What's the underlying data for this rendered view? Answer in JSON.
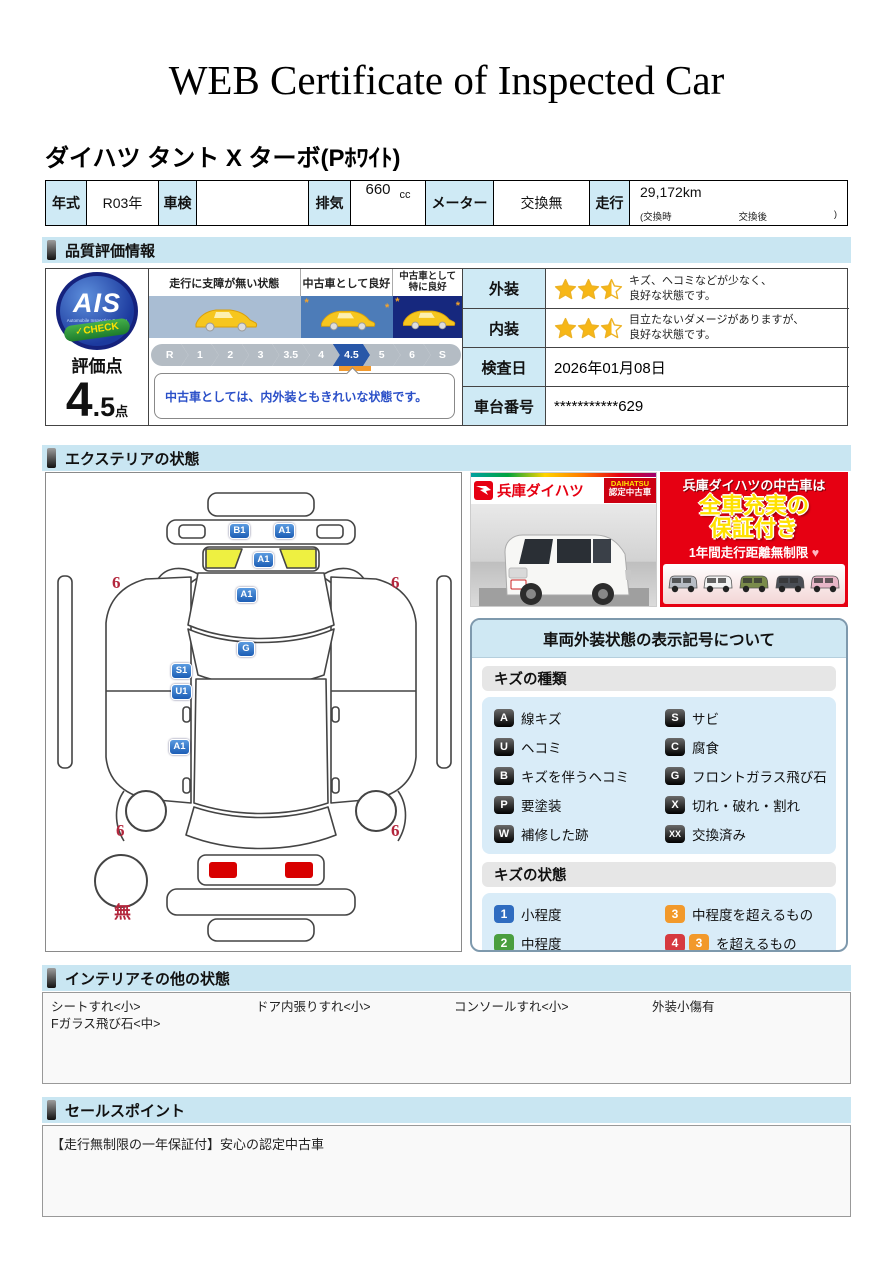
{
  "page": {
    "title": "WEB Certificate of Inspected Car"
  },
  "vehicle": {
    "name": "ダイハツ タント X ターボ(Pﾎﾜｲﾄ)",
    "info": {
      "year_label": "年式",
      "year": "R03年",
      "shaken_label": "車検",
      "shaken": "",
      "displacement_label": "排気",
      "displacement": "660",
      "displacement_unit": "cc",
      "meter_label": "メーター",
      "meter": "交換無",
      "mileage_label": "走行",
      "mileage": "29,172km",
      "mileage_note_open": "(交換時",
      "mileage_note_mid": "交換後",
      "mileage_note_close": ")"
    }
  },
  "quality": {
    "section_title": "品質評価情報",
    "ais": {
      "logo": "AIS",
      "logo_sub": "Automobile Inspection System",
      "logo_check": "✓CHECK",
      "score_label": "評価点",
      "score_int": "4",
      "score_dec": ".5",
      "score_unit": "点"
    },
    "scale": {
      "zones": [
        {
          "label": "走行に支障が無い状態",
          "color": "#a9bdd3"
        },
        {
          "label": "中古車として良好",
          "color": "#4d7cb8"
        },
        {
          "label": "中古車として\n特に良好",
          "color": "#16287e"
        }
      ],
      "ticks": [
        "R",
        "1",
        "2",
        "3",
        "3.5",
        "4",
        "4.5",
        "5",
        "6",
        "S"
      ],
      "selected": "4.5",
      "comment": "中古車としては、内外装ともきれいな状態です。"
    },
    "rows": [
      {
        "label": "外装",
        "stars": 2.5,
        "text": "キズ、ヘコミなどが少なく、\n良好な状態です。"
      },
      {
        "label": "内装",
        "stars": 2.5,
        "text": "目立たないダメージがありますが、\n良好な状態です。"
      }
    ],
    "inspection_date_label": "検査日",
    "inspection_date": "2026年01月08日",
    "vin_label": "車台番号",
    "vin": "***********629",
    "star_color": "#f7b716"
  },
  "exterior": {
    "section_title": "エクステリアの状態",
    "markers": [
      {
        "kind": "badge",
        "text": "B1",
        "x": 183,
        "y": 50
      },
      {
        "kind": "badge",
        "text": "A1",
        "x": 228,
        "y": 50
      },
      {
        "kind": "badge",
        "text": "A1",
        "x": 207,
        "y": 79
      },
      {
        "kind": "badge",
        "text": "A1",
        "x": 190,
        "y": 114
      },
      {
        "kind": "badge",
        "text": "G",
        "x": 191,
        "y": 168
      },
      {
        "kind": "badge",
        "text": "S1",
        "x": 125,
        "y": 190
      },
      {
        "kind": "badge",
        "text": "U1",
        "x": 125,
        "y": 211
      },
      {
        "kind": "badge",
        "text": "A1",
        "x": 123,
        "y": 266
      },
      {
        "kind": "red",
        "text": "6",
        "x": 66,
        "y": 100
      },
      {
        "kind": "red",
        "text": "6",
        "x": 345,
        "y": 100
      },
      {
        "kind": "red",
        "text": "6",
        "x": 70,
        "y": 348
      },
      {
        "kind": "red",
        "text": "6",
        "x": 345,
        "y": 348
      },
      {
        "kind": "red",
        "text": "無",
        "x": 68,
        "y": 425
      }
    ],
    "dealer_banner": {
      "brand": "兵庫ダイハツ",
      "badge_line1": "DAIHATSU",
      "badge_line2": "認定中古車"
    },
    "promo_banner": {
      "line1": "兵庫ダイハツの中古車は",
      "line2": "全車充実の",
      "line3": "保証付き",
      "line4": "1年間走行距離無制限",
      "heart": "♥",
      "lineup_colors": [
        "#b8bcc4",
        "#f2f2f2",
        "#7a8b4a",
        "#4a4e55",
        "#e8b7c8"
      ]
    },
    "legend": {
      "title": "車両外装状態の表示記号について",
      "kind_title": "キズの種類",
      "kinds": [
        {
          "code": "A",
          "label": "線キズ"
        },
        {
          "code": "S",
          "label": "サビ"
        },
        {
          "code": "U",
          "label": "ヘコミ"
        },
        {
          "code": "C",
          "label": "腐食"
        },
        {
          "code": "B",
          "label": "キズを伴うヘコミ"
        },
        {
          "code": "G",
          "label": "フロントガラス飛び石"
        },
        {
          "code": "P",
          "label": "要塗装"
        },
        {
          "code": "X",
          "label": "切れ・破れ・割れ"
        },
        {
          "code": "W",
          "label": "補修した跡"
        },
        {
          "code": "XX",
          "label": "交換済み"
        }
      ],
      "state_title": "キズの状態",
      "states": [
        {
          "codes": [
            "1"
          ],
          "colors": [
            "#2f6cc0"
          ],
          "label": "小程度"
        },
        {
          "codes": [
            "3"
          ],
          "colors": [
            "#f2992b"
          ],
          "label": "中程度を超えるもの"
        },
        {
          "codes": [
            "2"
          ],
          "colors": [
            "#4a9e3f"
          ],
          "label": "中程度"
        },
        {
          "codes": [
            "4",
            "3"
          ],
          "colors": [
            "#d6393f",
            "#f2992b"
          ],
          "label": "を超えるもの"
        }
      ]
    }
  },
  "interior": {
    "section_title": "インテリアその他の状態",
    "items": [
      "シートすれ<小>",
      "ドア内張りすれ<小>",
      "コンソールすれ<小>",
      "外装小傷有",
      "Fガラス飛び石<中>"
    ]
  },
  "sales": {
    "section_title": "セールスポイント",
    "text": "【走行無制限の一年保証付】安心の認定中古車"
  }
}
